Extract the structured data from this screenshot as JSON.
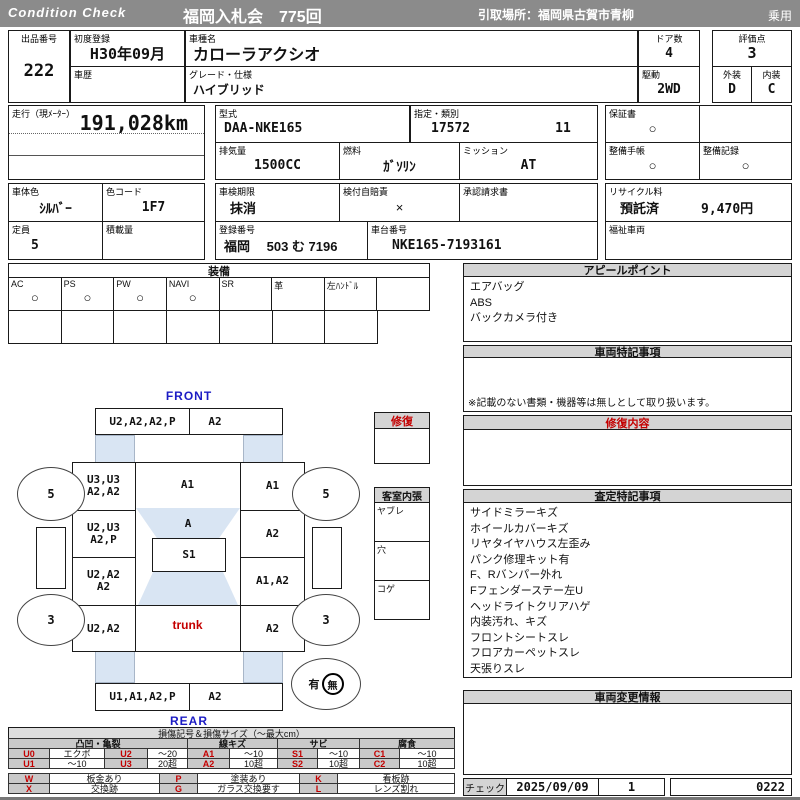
{
  "header": {
    "brand": "Condition  Check",
    "auction_title": "福岡入札会　775回",
    "pickup_place": "引取場所：福岡県古賀市青柳",
    "vehicle_category": "乗用"
  },
  "info": {
    "lot_label": "出品番号",
    "lot_no": "222",
    "first_reg_label": "初度登録",
    "first_reg": "H30年09月",
    "history_label": "車歴",
    "history": "",
    "model_label": "車種名",
    "model": "カローラアクシオ",
    "grade_label": "グレード・仕様",
    "grade": "ハイブリッド",
    "doors_label": "ドア数",
    "doors": "4",
    "drive_label": "駆動",
    "drive": "2WD",
    "score_label": "評価点",
    "score": "3",
    "exterior_label": "外装",
    "exterior_grade": "D",
    "interior_label": "内装",
    "interior_grade": "C",
    "mileage_label": "走行（現ﾒｰﾀｰ）",
    "mileage": "191,028km",
    "model_code_label": "型式",
    "model_code": "DAA-NKE165",
    "class_label": "指定・類別",
    "class_no": "17572",
    "class_sub": "11",
    "displacement_label": "排気量",
    "displacement": "1500CC",
    "fuel_label": "燃料",
    "fuel": "ｶﾞｿﾘﾝ",
    "mission_label": "ミッション",
    "mission": "AT",
    "warranty_label": "保証書",
    "warranty_mark": "○",
    "book_label": "整備手帳",
    "book_mark": "○",
    "record_label": "整備記録",
    "record_mark": "○",
    "color_label": "車体色",
    "body_color": "ｼﾙﾊﾞｰ",
    "color_code_label": "色コード",
    "color_code": "1F7",
    "inspection_label": "車検期限",
    "inspection": "抹消",
    "insurance_label": "検付自賠責",
    "insurance_mark": "×",
    "approval_label": "承認請求書",
    "approval": "",
    "recycle_label": "リサイクル料",
    "recycle_status": "預託済",
    "recycle_fee": "9,470円",
    "capacity_label": "定員",
    "capacity": "5",
    "load_label": "積載量",
    "load": "",
    "plate_label": "登録番号",
    "plate": "福岡　 503 む 7196",
    "vin_label": "車台番号",
    "vin": "NKE165-7193161",
    "welfare_label": "福祉車両",
    "welfare": ""
  },
  "equipment": {
    "title": "装備",
    "items": [
      {
        "label": "AC",
        "mark": "○"
      },
      {
        "label": "PS",
        "mark": "○"
      },
      {
        "label": "PW",
        "mark": "○"
      },
      {
        "label": "NAVI",
        "mark": "○"
      },
      {
        "label": "SR",
        "mark": ""
      },
      {
        "label": "革",
        "mark": ""
      },
      {
        "label": "左ﾊﾝﾄﾞﾙ",
        "mark": ""
      },
      {
        "label": "",
        "mark": ""
      }
    ]
  },
  "appeal": {
    "title": "アピールポイント",
    "lines": [
      "エアバッグ",
      "ABS",
      "バックカメラ付き"
    ]
  },
  "special": {
    "title": "車両特記事項",
    "disclaimer": "※記載のない書類・機器等は無しとして取り扱います。"
  },
  "repair": {
    "box_title": "修復",
    "detail_title": "修復内容"
  },
  "cabin": {
    "title": "客室内張",
    "row1": "ヤブレ",
    "row2": "穴",
    "row3": "コゲ"
  },
  "assessment": {
    "title": "査定特記事項",
    "lines": [
      "サイドミラーキズ",
      "ホイールカバーキズ",
      "リヤタイヤハウス左歪み",
      "パンク修理キット有",
      "F、Rバンパー外れ",
      "Fフェンダーステー左U",
      "ヘッドライトクリアハゲ",
      "内装汚れ、キズ",
      "フロントシートスレ",
      "フロアカーペットスレ",
      "天張りスレ"
    ]
  },
  "change_info": {
    "title": "車両変更情報"
  },
  "check": {
    "label": "チェック",
    "date": "2025/09/09",
    "count": "1",
    "code": "0222"
  },
  "diagram": {
    "front_label": "FRONT",
    "rear_label": "REAR",
    "front_bumper_left": "U2,A2,A2,P",
    "front_bumper_right": "A2",
    "left_front_fender": "U3,U3\nA2,A2",
    "hood": "A1",
    "right_front_fender": "A1",
    "left_front_door": "U2,U3\nA2,P",
    "windshield": "A",
    "right_front_door": "A2",
    "roof": "S1",
    "left_rear_door": "U2,A2\nA2",
    "right_rear_door": "A1,A2",
    "left_quarter": "U2,A2",
    "trunk": "trunk",
    "right_quarter": "A2",
    "rear_bumper_left": "U1,A1,A2,P",
    "rear_bumper_right": "A2",
    "front_tire_depth": "5",
    "rear_tire_depth": "3",
    "marker_yes": "有",
    "marker_no": "無"
  },
  "legend": {
    "title": "損傷記号＆損傷サイズ（〜最大cm）",
    "groups": [
      "凸凹・亀裂",
      "線キズ",
      "サビ",
      "腐食"
    ],
    "row1": [
      "U0",
      "エクボ",
      "U2",
      "〜20",
      "A1",
      "〜10",
      "S1",
      "〜10",
      "C1",
      "〜10"
    ],
    "row2": [
      "U1",
      "〜10",
      "U3",
      "20超",
      "A2",
      "10超",
      "S2",
      "10超",
      "C2",
      "10超"
    ],
    "row3": [
      "W",
      "板金あり",
      "P",
      "塗装あり",
      "K",
      "看板跡"
    ],
    "row4": [
      "X",
      "交換跡",
      "G",
      "ガラス交換要す",
      "L",
      "レンズ割れ"
    ]
  }
}
